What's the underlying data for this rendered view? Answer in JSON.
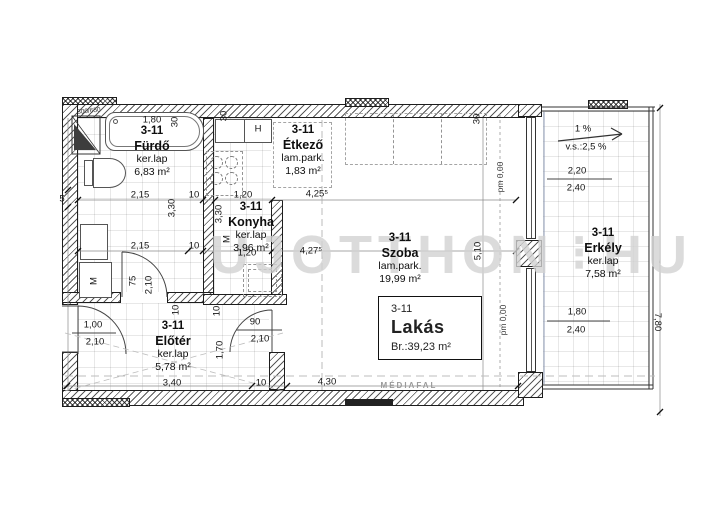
{
  "watermark": {
    "part1": "UJOTTHON",
    "sep": "⋮",
    "part2": "HU"
  },
  "plan": {
    "unit": {
      "code": "3-11",
      "name": "Lakás",
      "area": "Br.:39,23 m²"
    },
    "rooms": [
      {
        "code": "3-11",
        "name": "Fürdő",
        "floor": "ker.lap",
        "area": "6,83 m²",
        "cx": 152,
        "y": 125
      },
      {
        "code": "3-11",
        "name": "Étkező",
        "floor": "lam.park.",
        "area": "1,83 m²",
        "cx": 303,
        "y": 124
      },
      {
        "code": "3-11",
        "name": "Konyha",
        "floor": "ker.lap",
        "area": "3,96 m²",
        "cx": 251,
        "y": 201
      },
      {
        "code": "3-11",
        "name": "Szoba",
        "floor": "lam.park.",
        "area": "19,99 m²",
        "cx": 400,
        "y": 232
      },
      {
        "code": "3-11",
        "name": "Előtér",
        "floor": "ker.lap",
        "area": "5,78 m²",
        "cx": 173,
        "y": 320
      },
      {
        "code": "3-11",
        "name": "Erkély",
        "floor": "ker.lap",
        "area": "7,58 m²",
        "cx": 603,
        "y": 227
      }
    ],
    "dims": [
      {
        "t": "300/650",
        "x": 89,
        "y": 112,
        "r": -6,
        "c": "t"
      },
      {
        "t": "1,80",
        "x": 152,
        "y": 120,
        "c": "d"
      },
      {
        "t": "30",
        "x": 175,
        "y": 122,
        "r": -90,
        "c": "d"
      },
      {
        "t": "30",
        "x": 224,
        "y": 116,
        "r": -90,
        "c": "d"
      },
      {
        "t": "H",
        "x": 258,
        "y": 129,
        "c": "d"
      },
      {
        "t": "30",
        "x": 477,
        "y": 119,
        "r": -90,
        "c": "d"
      },
      {
        "t": "5",
        "x": 62,
        "y": 199,
        "c": "d"
      },
      {
        "t": "2,15",
        "x": 140,
        "y": 195,
        "c": "d"
      },
      {
        "t": "10",
        "x": 194,
        "y": 195,
        "c": "d"
      },
      {
        "t": "1,20",
        "x": 243,
        "y": 195,
        "c": "d"
      },
      {
        "t": "4,25⁵",
        "x": 317,
        "y": 194,
        "c": "d"
      },
      {
        "t": "3,30",
        "x": 172,
        "y": 208,
        "r": -90,
        "c": "d"
      },
      {
        "t": "3,30",
        "x": 219,
        "y": 214,
        "r": -90,
        "c": "d"
      },
      {
        "t": "M",
        "x": 227,
        "y": 239,
        "r": -90,
        "c": "d"
      },
      {
        "t": "2,15",
        "x": 140,
        "y": 246,
        "c": "d"
      },
      {
        "t": "10",
        "x": 194,
        "y": 246,
        "c": "d"
      },
      {
        "t": "1,20",
        "x": 247,
        "y": 253,
        "c": "d"
      },
      {
        "t": "4,27⁵",
        "x": 311,
        "y": 251,
        "c": "d"
      },
      {
        "t": "5,10",
        "x": 478,
        "y": 251,
        "r": -90,
        "c": "d"
      },
      {
        "t": "pm 0,00",
        "x": 500,
        "y": 177,
        "r": -90,
        "c": "pm"
      },
      {
        "t": "pm 0,00",
        "x": 503,
        "y": 320,
        "r": -90,
        "c": "pm"
      },
      {
        "t": "1 %",
        "x": 583,
        "y": 129,
        "c": "d"
      },
      {
        "t": "v.s.:2,5 %",
        "x": 586,
        "y": 147,
        "c": "d"
      },
      {
        "t": "2,20",
        "x": 577,
        "y": 171,
        "c": "d"
      },
      {
        "t": "2,40",
        "x": 576,
        "y": 188,
        "c": "d"
      },
      {
        "t": "1,80",
        "x": 577,
        "y": 312,
        "c": "d"
      },
      {
        "t": "2,40",
        "x": 576,
        "y": 330,
        "c": "d"
      },
      {
        "t": "7,80",
        "x": 657,
        "y": 322,
        "r": 90,
        "c": "d"
      },
      {
        "t": "75",
        "x": 133,
        "y": 281,
        "r": -90,
        "c": "d"
      },
      {
        "t": "2,10",
        "x": 149,
        "y": 285,
        "r": -90,
        "c": "d"
      },
      {
        "t": "10",
        "x": 176,
        "y": 310,
        "r": -90,
        "c": "d"
      },
      {
        "t": "10",
        "x": 217,
        "y": 311,
        "r": -90,
        "c": "d"
      },
      {
        "t": "M",
        "x": 94,
        "y": 281,
        "r": -90,
        "c": "d"
      },
      {
        "t": "1,00",
        "x": 93,
        "y": 325,
        "c": "d"
      },
      {
        "t": "2,10",
        "x": 95,
        "y": 342,
        "c": "d"
      },
      {
        "t": "90",
        "x": 255,
        "y": 322,
        "c": "d"
      },
      {
        "t": "2,10",
        "x": 260,
        "y": 339,
        "c": "d"
      },
      {
        "t": "1,70",
        "x": 220,
        "y": 350,
        "r": -90,
        "c": "d"
      },
      {
        "t": "3,40",
        "x": 172,
        "y": 383,
        "c": "d"
      },
      {
        "t": "10",
        "x": 261,
        "y": 383,
        "c": "d"
      },
      {
        "t": "4,30",
        "x": 327,
        "y": 382,
        "c": "d"
      },
      {
        "t": "MÉDIAFAL",
        "x": 409,
        "y": 386,
        "c": "g"
      }
    ]
  }
}
